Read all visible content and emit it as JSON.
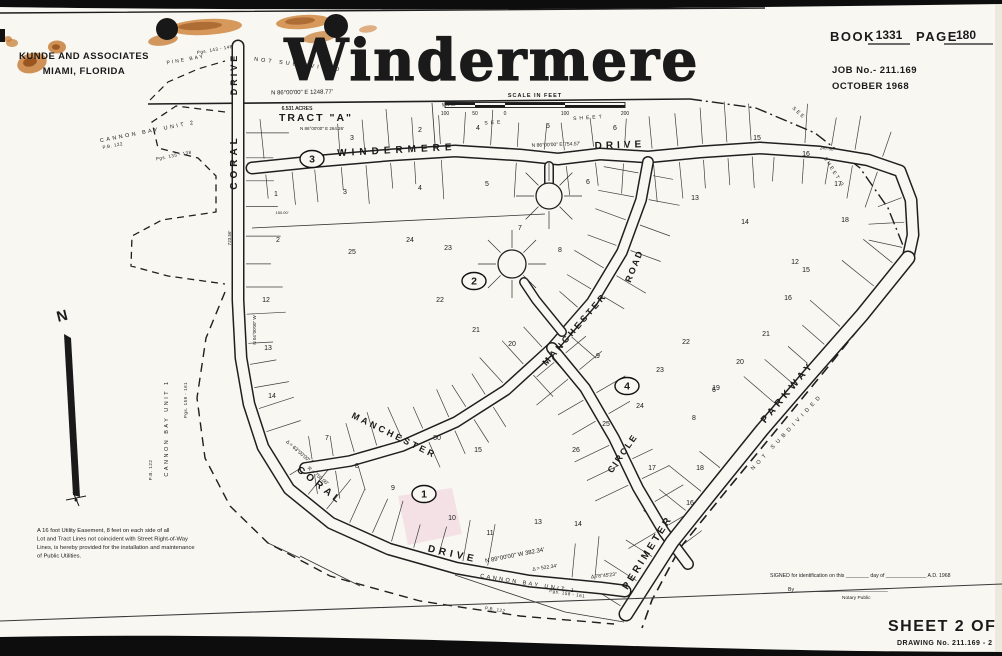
{
  "header": {
    "firm_line1": "KUNDE AND ASSOCIATES",
    "firm_line2": "MIAMI,  FLORIDA",
    "title": "Windermere",
    "book_label": "BOOK",
    "book_value": "1331",
    "page_label": "PAGE",
    "page_value": "180",
    "job_no": "JOB No.- 211.169",
    "date": "OCTOBER   1968"
  },
  "footer": {
    "signature_line": "SIGNED   for  identification  on  this ________ day  of ______________ A.D.  1968",
    "by_line": "By ________________________________",
    "notary": "Notary  Public",
    "sheet": "SHEET 2 OF 5",
    "drawing_no": "DRAWING  No. 211.169 - 2"
  },
  "notes": {
    "easement_lines": [
      "A 16 foot Utility Easement, 8 feet on each side of all",
      "Lot and Tract Lines not coincident with Street Right-of-Way",
      "Lines, is hereby provided for the installation and maintenance",
      "of Public Utilities."
    ]
  },
  "map": {
    "north_label": "N",
    "tract_label": "TRACT  \"A\"",
    "tract_acres": "6.531  ACRES",
    "scale": {
      "label": "SCALE IN FEET",
      "ticks": [
        "100",
        "50",
        "0",
        "100",
        "200"
      ]
    },
    "blocks": [
      {
        "n": "1",
        "x": 424,
        "y": 494
      },
      {
        "n": "2",
        "x": 474,
        "y": 281
      },
      {
        "n": "3",
        "x": 312,
        "y": 159
      },
      {
        "n": "4",
        "x": 627,
        "y": 386
      }
    ],
    "street_labels": [
      {
        "text": "DRIVE",
        "x": 237,
        "y": 74,
        "rot": -90,
        "size": 9,
        "ls": 3
      },
      {
        "text": "CORAL",
        "x": 237,
        "y": 162,
        "rot": -90,
        "size": 10,
        "ls": 4
      },
      {
        "text": "WINDERMERE",
        "x": 397,
        "y": 153,
        "rot": -3,
        "size": 10,
        "ls": 5
      },
      {
        "text": "DRIVE",
        "x": 620,
        "y": 148,
        "rot": -2,
        "size": 10,
        "ls": 4
      },
      {
        "text": "CORAL",
        "x": 318,
        "y": 488,
        "rot": 38,
        "size": 10,
        "ls": 4
      },
      {
        "text": "DRIVE",
        "x": 452,
        "y": 557,
        "rot": 13,
        "size": 10,
        "ls": 4
      },
      {
        "text": "MANCHESTER",
        "x": 577,
        "y": 331,
        "rot": -49,
        "size": 9,
        "ls": 3
      },
      {
        "text": "ROAD",
        "x": 637,
        "y": 267,
        "rot": -68,
        "size": 9,
        "ls": 2
      },
      {
        "text": "MANCHESTER",
        "x": 393,
        "y": 438,
        "rot": 26,
        "size": 9,
        "ls": 3
      },
      {
        "text": "CIRCLE",
        "x": 625,
        "y": 455,
        "rot": -55,
        "size": 9,
        "ls": 2
      },
      {
        "text": "PERIMETER",
        "x": 650,
        "y": 554,
        "rot": -58,
        "size": 10,
        "ls": 3
      },
      {
        "text": "PARKWAY",
        "x": 790,
        "y": 394,
        "rot": -50,
        "size": 10,
        "ls": 4
      }
    ],
    "area_labels": [
      {
        "text": "PINE BAY",
        "x": 186,
        "y": 61,
        "rot": -10,
        "size": 5,
        "ls": 2
      },
      {
        "text": "Pgs. 143 - 148",
        "x": 215,
        "y": 51,
        "rot": -10,
        "size": 4.5,
        "ls": 0.5
      },
      {
        "text": "NOT   SUBDIVIDED",
        "x": 298,
        "y": 66,
        "rot": 7,
        "size": 5.5,
        "ls": 3
      },
      {
        "text": "CANNON  BAY  UNIT  2",
        "x": 148,
        "y": 133,
        "rot": -11,
        "size": 5.5,
        "ls": 2.5
      },
      {
        "text": "P.B. 122",
        "x": 113,
        "y": 147,
        "rot": -11,
        "size": 4.5,
        "ls": 0.5
      },
      {
        "text": "Pgs. 135 - 138",
        "x": 174,
        "y": 157,
        "rot": -11,
        "size": 4.5,
        "ls": 0.5
      },
      {
        "text": "CANNON  BAY  UNIT  1",
        "x": 168,
        "y": 428,
        "rot": -90,
        "size": 5.5,
        "ls": 2.5
      },
      {
        "text": "P.B. 122",
        "x": 152,
        "y": 470,
        "rot": -90,
        "size": 4.5,
        "ls": 0.5
      },
      {
        "text": "Pgs. 158 - 161",
        "x": 187,
        "y": 400,
        "rot": -90,
        "size": 4.5,
        "ls": 0.5
      },
      {
        "text": "CANNON  BAY  UNIT  1",
        "x": 528,
        "y": 585,
        "rot": 9,
        "size": 5.5,
        "ls": 2.5
      },
      {
        "text": "Pgs. 158 - 161",
        "x": 567,
        "y": 595,
        "rot": 9,
        "size": 4.5,
        "ls": 0.5
      },
      {
        "text": "P.B. 122",
        "x": 495,
        "y": 611,
        "rot": 9,
        "size": 4.5,
        "ls": 0.5
      },
      {
        "text": "NOT  SUBDIVIDED",
        "x": 788,
        "y": 433,
        "rot": -47,
        "size": 5.5,
        "ls": 4
      },
      {
        "text": "SEE",
        "x": 494,
        "y": 124,
        "rot": -4,
        "size": 5,
        "ls": 3
      },
      {
        "text": "SHEET",
        "x": 589,
        "y": 119,
        "rot": -4,
        "size": 5,
        "ls": 3
      },
      {
        "text": "SEE",
        "x": 798,
        "y": 114,
        "rot": 42,
        "size": 5,
        "ls": 2
      },
      {
        "text": "SHEET  3",
        "x": 833,
        "y": 173,
        "rot": 58,
        "size": 5,
        "ls": 2
      }
    ],
    "annotations": [
      {
        "text": "N 86°00'00\" E      1248.77'",
        "x": 302,
        "y": 94,
        "rot": -1,
        "size": 6
      },
      {
        "text": "6.531  ACRES",
        "x": 297,
        "y": 110,
        "rot": 0,
        "size": 5
      },
      {
        "text": "534.58'",
        "x": 449,
        "y": 106,
        "rot": -2,
        "size": 4.5
      },
      {
        "text": "N 86°00'00\" E    754.57'",
        "x": 556,
        "y": 146,
        "rot": -2,
        "size": 5
      },
      {
        "text": "247.50'",
        "x": 827,
        "y": 150,
        "rot": 6,
        "size": 4.5
      },
      {
        "text": "N 86°00'00\" E   264.26'",
        "x": 322,
        "y": 130,
        "rot": 0,
        "size": 4.5
      },
      {
        "text": "N 89°00'00\" W    382.34'",
        "x": 515,
        "y": 557,
        "rot": -11,
        "size": 6
      },
      {
        "text": "Δ = 522.34'",
        "x": 545,
        "y": 569,
        "rot": -8,
        "size": 5
      },
      {
        "text": "Δ 78°45'23\"",
        "x": 604,
        "y": 577,
        "rot": -6,
        "size": 5
      },
      {
        "text": "R = 750.00'",
        "x": 317,
        "y": 477,
        "rot": 40,
        "size": 5
      },
      {
        "text": "Δ = 63°00'00\"",
        "x": 297,
        "y": 452,
        "rot": 41,
        "size": 5
      },
      {
        "text": "723.56'",
        "x": 231,
        "y": 238,
        "rot": -90,
        "size": 4.5
      },
      {
        "text": "N 04°00'00\" W",
        "x": 256,
        "y": 330,
        "rot": -90,
        "size": 4.5
      },
      {
        "text": "150.00'",
        "x": 282,
        "y": 214,
        "rot": 0,
        "size": 4
      }
    ],
    "lots": [
      {
        "n": "2",
        "x": 420,
        "y": 132
      },
      {
        "n": "3",
        "x": 352,
        "y": 140
      },
      {
        "n": "4",
        "x": 478,
        "y": 130
      },
      {
        "n": "5",
        "x": 548,
        "y": 128
      },
      {
        "n": "6",
        "x": 615,
        "y": 130
      },
      {
        "n": "15",
        "x": 757,
        "y": 140
      },
      {
        "n": "16",
        "x": 806,
        "y": 156
      },
      {
        "n": "17",
        "x": 838,
        "y": 186
      },
      {
        "n": "18",
        "x": 845,
        "y": 222
      },
      {
        "n": "3",
        "x": 345,
        "y": 194
      },
      {
        "n": "4",
        "x": 420,
        "y": 190
      },
      {
        "n": "5",
        "x": 487,
        "y": 186
      },
      {
        "n": "6",
        "x": 588,
        "y": 184
      },
      {
        "n": "13",
        "x": 695,
        "y": 200
      },
      {
        "n": "14",
        "x": 745,
        "y": 224
      },
      {
        "n": "12",
        "x": 795,
        "y": 264
      },
      {
        "n": "1",
        "x": 276,
        "y": 196
      },
      {
        "n": "2",
        "x": 278,
        "y": 242
      },
      {
        "n": "25",
        "x": 352,
        "y": 254
      },
      {
        "n": "24",
        "x": 410,
        "y": 242
      },
      {
        "n": "23",
        "x": 448,
        "y": 250
      },
      {
        "n": "22",
        "x": 440,
        "y": 302
      },
      {
        "n": "21",
        "x": 476,
        "y": 332
      },
      {
        "n": "20",
        "x": 512,
        "y": 346
      },
      {
        "n": "8",
        "x": 560,
        "y": 252
      },
      {
        "n": "7",
        "x": 520,
        "y": 230
      },
      {
        "n": "12",
        "x": 266,
        "y": 302
      },
      {
        "n": "13",
        "x": 268,
        "y": 350
      },
      {
        "n": "14",
        "x": 272,
        "y": 398
      },
      {
        "n": "7",
        "x": 327,
        "y": 440
      },
      {
        "n": "8",
        "x": 357,
        "y": 468
      },
      {
        "n": "9",
        "x": 393,
        "y": 490
      },
      {
        "n": "50",
        "x": 437,
        "y": 440
      },
      {
        "n": "15",
        "x": 478,
        "y": 452
      },
      {
        "n": "10",
        "x": 452,
        "y": 520
      },
      {
        "n": "11",
        "x": 490,
        "y": 535
      },
      {
        "n": "13",
        "x": 538,
        "y": 524
      },
      {
        "n": "14",
        "x": 578,
        "y": 526
      },
      {
        "n": "9",
        "x": 598,
        "y": 358
      },
      {
        "n": "22",
        "x": 686,
        "y": 344
      },
      {
        "n": "23",
        "x": 660,
        "y": 372
      },
      {
        "n": "24",
        "x": 640,
        "y": 408
      },
      {
        "n": "25",
        "x": 606,
        "y": 426
      },
      {
        "n": "26",
        "x": 576,
        "y": 452
      },
      {
        "n": "17",
        "x": 652,
        "y": 470
      },
      {
        "n": "8",
        "x": 694,
        "y": 420
      },
      {
        "n": "6",
        "x": 714,
        "y": 392
      },
      {
        "n": "19",
        "x": 716,
        "y": 390
      },
      {
        "n": "20",
        "x": 740,
        "y": 364
      },
      {
        "n": "21",
        "x": 766,
        "y": 336
      },
      {
        "n": "16",
        "x": 788,
        "y": 300
      },
      {
        "n": "15",
        "x": 806,
        "y": 272
      },
      {
        "n": "16",
        "x": 690,
        "y": 505
      },
      {
        "n": "18",
        "x": 700,
        "y": 470
      }
    ]
  }
}
